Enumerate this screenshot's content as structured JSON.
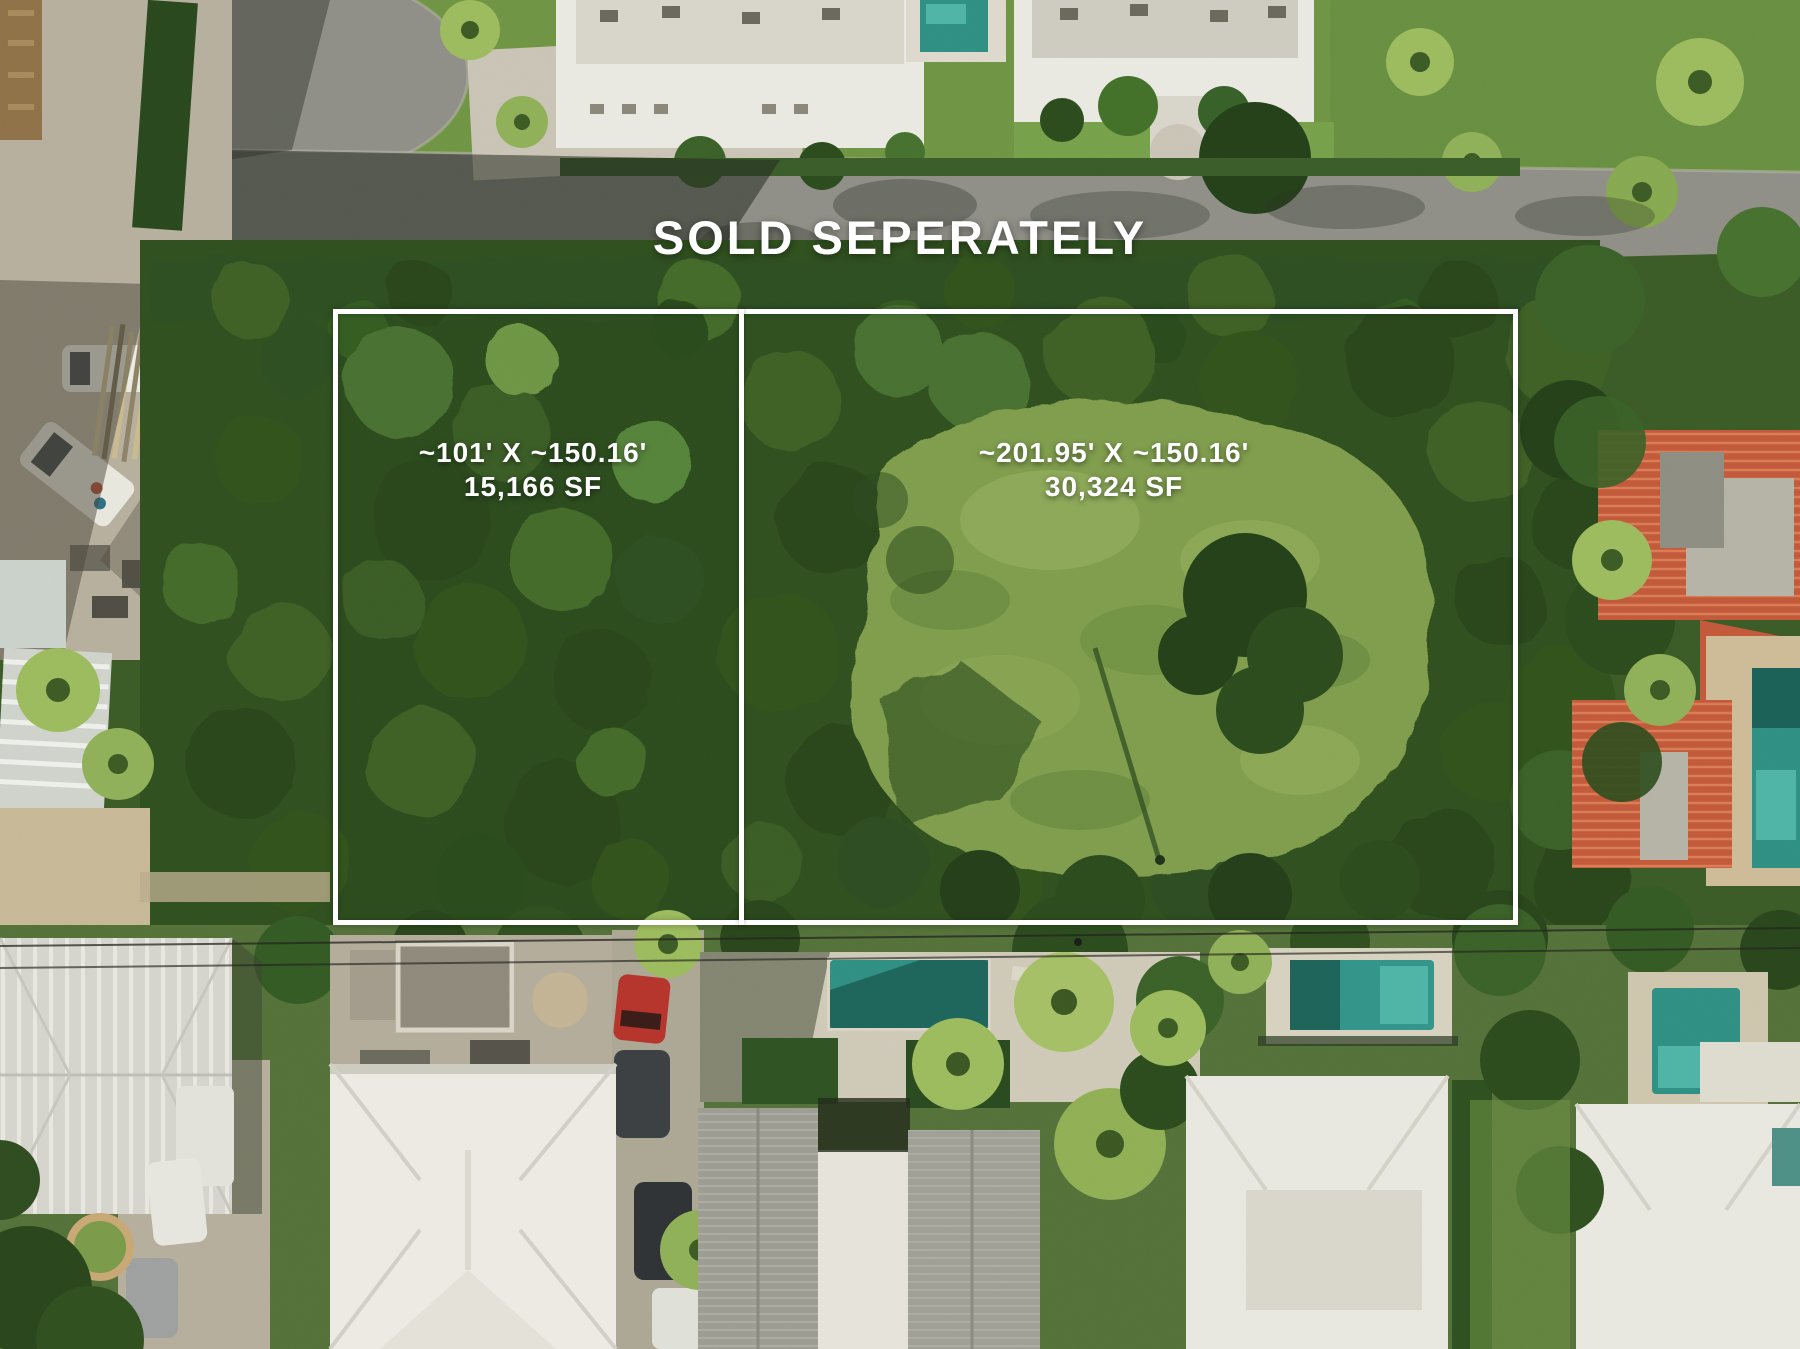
{
  "overlay": {
    "headline": "SOLD SEPERATELY",
    "boundary_color": "#ffffff",
    "text_color": "#ffffff",
    "lots": [
      {
        "id": "west",
        "dimensions": "~101' X ~150.16'",
        "area": "15,166 SF"
      },
      {
        "id": "east",
        "dimensions": "~201.95' X ~150.16'",
        "area": "30,324 SF"
      }
    ]
  }
}
